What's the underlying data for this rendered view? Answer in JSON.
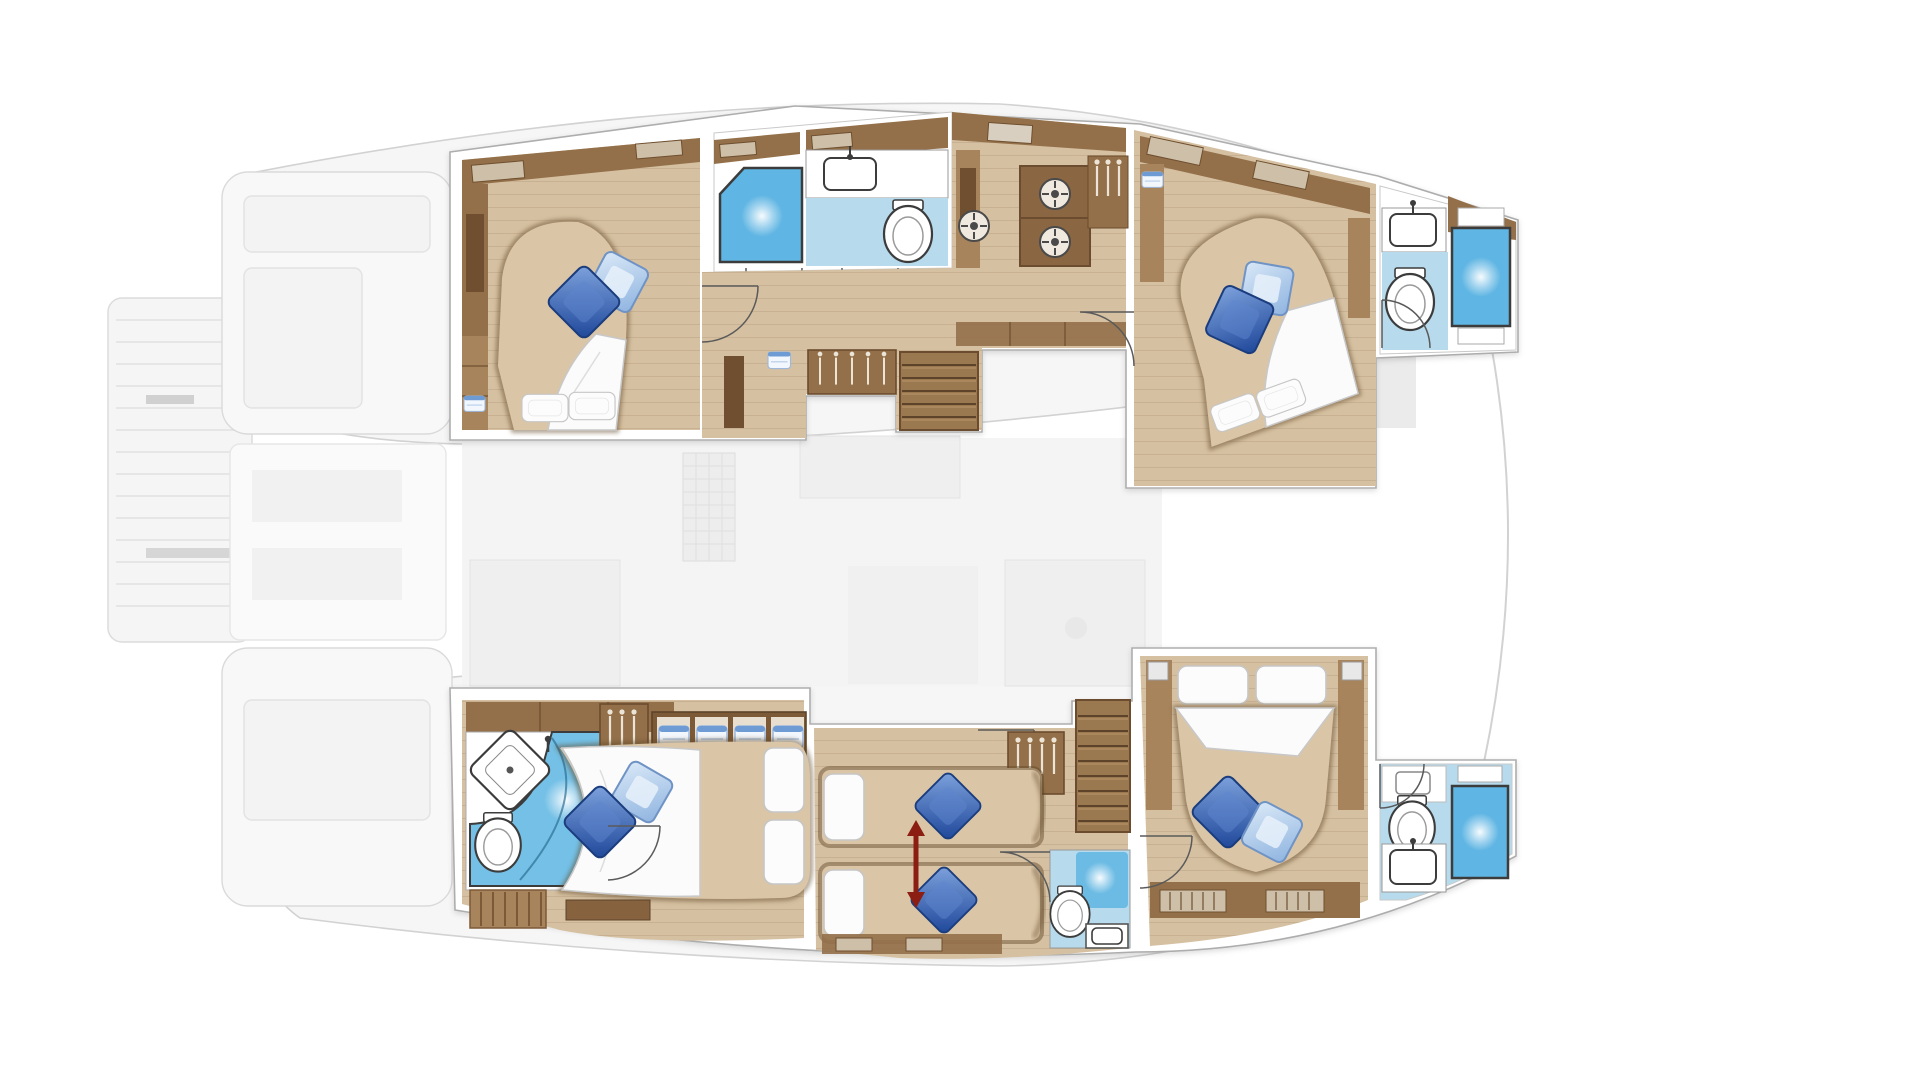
{
  "page": {
    "title": "Catamaran yacht lower-deck floor plan",
    "type": "floor-plan",
    "visible_text": "none",
    "orientation": "bow to the right, two hulls top and bottom, bridge deck ghosted in grey"
  },
  "palette": {
    "bg": "#ffffff",
    "ghost_fill": "#f6f6f6",
    "ghost_stroke": "#d2d2d2",
    "ghost_furniture": "#ececec",
    "wall_white": "#ffffff",
    "wall_outline": "#adadad",
    "floor_wood": "#d5c0a1",
    "floor_plank_line": "#b49a7c",
    "cabinet_brown": "#93704a",
    "cabinet_mid": "#a8845c",
    "cabinet_dark": "#6f4f2f",
    "bed_tan": "#dac5a6",
    "bed_shadow": "#5f4628",
    "linen_white": "#fbfbfb",
    "linen_stroke": "#c8c8c8",
    "pillow_dark_blue": "#2e62ba",
    "pillow_light_blue": "#a9cbee",
    "bath_floor_blue": "#b7dbec",
    "shower_blue": "#5fb5e3",
    "towel_blue": "#6f9bd4",
    "stair_light": "#b08c60",
    "stair_dark": "#9a7850",
    "step_line": "#5d432a",
    "arrow_red": "#8c1d12",
    "door_arc": "#5a5a5a",
    "fixture_outline": "#3c3c3c"
  },
  "rooms": [
    {
      "id": "top-aft-cabin",
      "hull": "upper",
      "name": "aft double cabin",
      "features": [
        "double bed, head aft with 2 white pillows",
        "dark + light blue accent pillows",
        "wardrobe band",
        "side cabinet column",
        "entry door"
      ]
    },
    {
      "id": "top-aft-bathroom",
      "hull": "upper",
      "name": "aft bathroom",
      "features": [
        "corner shower with angled glass",
        "washbasin on white counter",
        "toilet",
        "two door swings"
      ]
    },
    {
      "id": "top-galley",
      "hull": "upper",
      "name": "galley / utility corridor",
      "features": [
        "brown cabinetry",
        "3 round appliance/burner symbols",
        "hanging locker",
        "companionway stairs to saloon"
      ]
    },
    {
      "id": "top-fwd-cabin",
      "hull": "upper",
      "name": "forward double cabin",
      "features": [
        "angled double bed with white duvet",
        "blue accent pillows",
        "sloped wardrobe band",
        "door swing"
      ]
    },
    {
      "id": "top-fwd-bathroom",
      "hull": "upper",
      "name": "forward bathroom",
      "features": [
        "rectangular shower cabin",
        "washbasin",
        "toilet",
        "door swing"
      ]
    },
    {
      "id": "bottom-aft-cabin",
      "hull": "lower",
      "name": "aft double cabin with en-suite",
      "features": [
        "double bed, head to starboard",
        "diamond corner washbasin",
        "toilet",
        "curved-glass shower",
        "teak shower mat",
        "hanging locker",
        "4 towel cubbies",
        "dresser"
      ]
    },
    {
      "id": "bottom-mid-cabin",
      "hull": "lower",
      "name": "convertible twin cabin",
      "features": [
        "two single beds head-to-head",
        "red conversion arrow",
        "hanging locker",
        "en-suite shower room with toilet and basin",
        "companionway stairs"
      ]
    },
    {
      "id": "bottom-fwd-cabin",
      "hull": "lower",
      "name": "forward double cabin",
      "features": [
        "double bed, head forward, 2 white pillows",
        "blue accent pillows",
        "side columns with speakers",
        "towel rails",
        "door swing"
      ]
    },
    {
      "id": "bottom-fwd-bathroom",
      "hull": "lower",
      "name": "forward bathroom",
      "features": [
        "rectangular shower cabin",
        "washbasin",
        "toilet",
        "door swing"
      ]
    }
  ],
  "ghost_elements": [
    "catamaran twin-hull silhouette",
    "aft swim platform with slats",
    "aft deck modules",
    "saloon/cockpit with grated table",
    "seating blobs",
    "trampoline pads near bows",
    "bow tips and forestay curve"
  ],
  "counts": {
    "cabins": 5,
    "double_beds": 4,
    "single_beds": 2,
    "bathrooms": 4,
    "showers": 4,
    "toilets": 4,
    "washbasins": 4,
    "staircases": 2,
    "blue_accent_pillows": 8,
    "white_pillows": 8,
    "door_swings": 9,
    "round_appliances": 3,
    "towel_cubbies": 4
  }
}
